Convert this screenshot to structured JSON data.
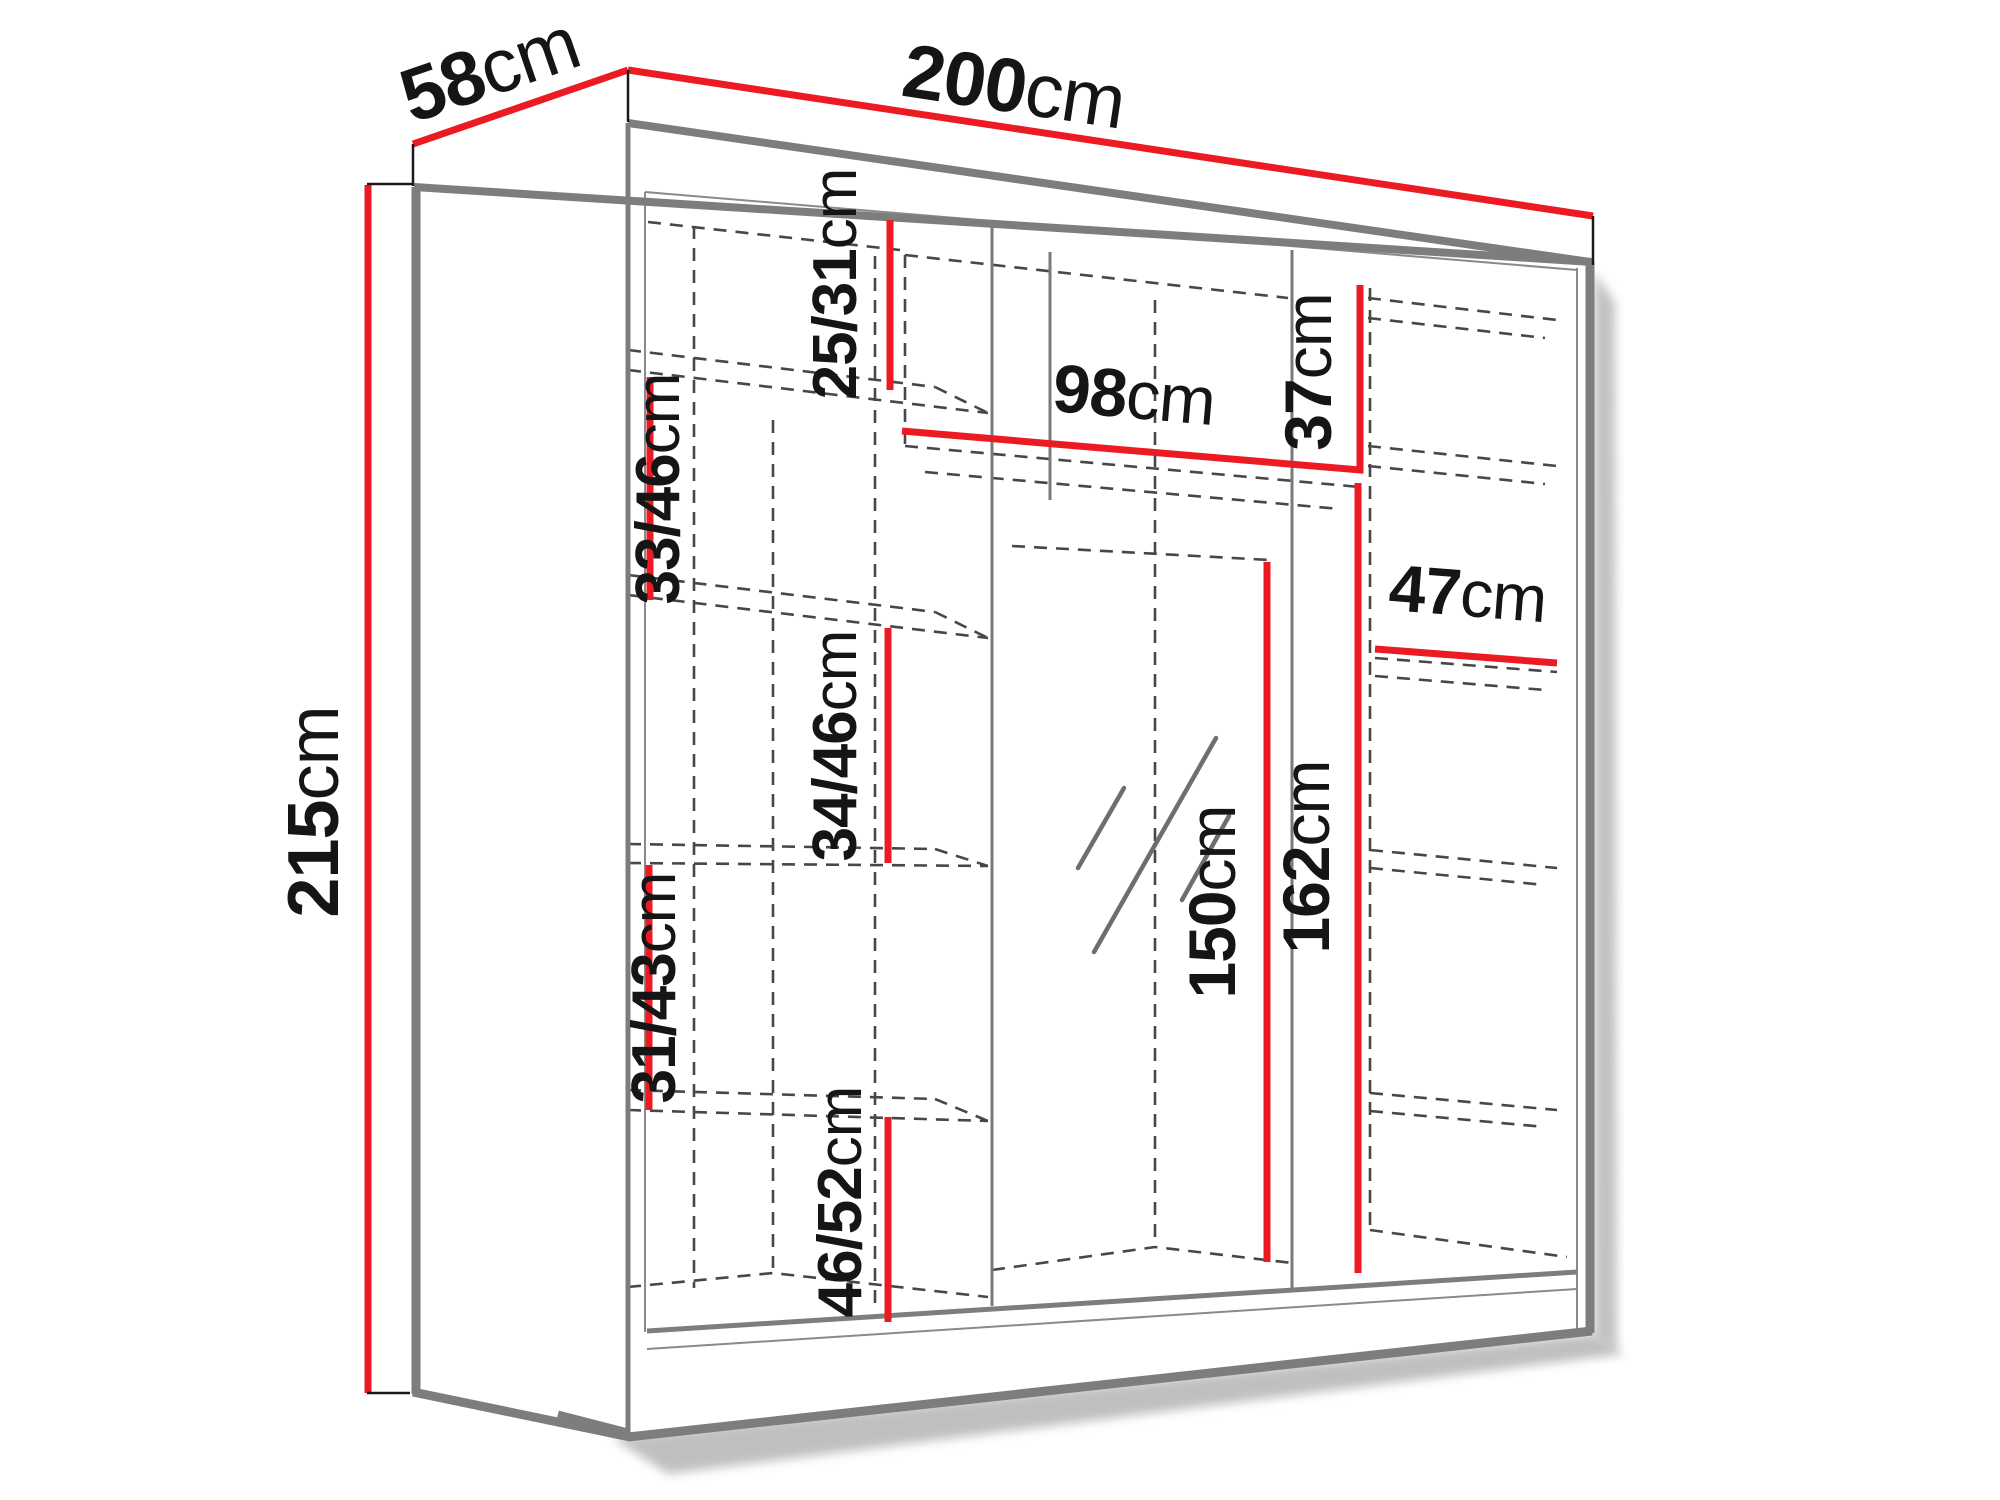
{
  "diagram": {
    "type": "furniture-dimension-diagram",
    "subject": "three-section sliding wardrobe with mirror, interior shelves shown dashed",
    "unit": "cm",
    "colors": {
      "dimension_line": "#ec1b23",
      "cabinet_edges": "#7d7d7d",
      "dashed_interior": "#474747",
      "label_text": "#151515",
      "background": "#ffffff"
    },
    "measurements": {
      "width": {
        "value": "200",
        "unit": "cm"
      },
      "depth": {
        "value": "58",
        "unit": "cm"
      },
      "height": {
        "value": "215",
        "unit": "cm"
      },
      "top_shelf_mid": {
        "value": "25/31",
        "unit": "cm"
      },
      "mid_shelf_width": {
        "value": "98",
        "unit": "cm"
      },
      "top_shelf_right": {
        "value": "37",
        "unit": "cm"
      },
      "left_gap_1": {
        "value": "33/46",
        "unit": "cm"
      },
      "right_shelf_width": {
        "value": "47",
        "unit": "cm"
      },
      "left_gap_2": {
        "value": "34/46",
        "unit": "cm"
      },
      "hanging_mid": {
        "value": "150",
        "unit": "cm"
      },
      "hanging_right": {
        "value": "162",
        "unit": "cm"
      },
      "left_gap_3": {
        "value": "31/43",
        "unit": "cm"
      },
      "left_gap_4": {
        "value": "46/52",
        "unit": "cm"
      }
    }
  }
}
